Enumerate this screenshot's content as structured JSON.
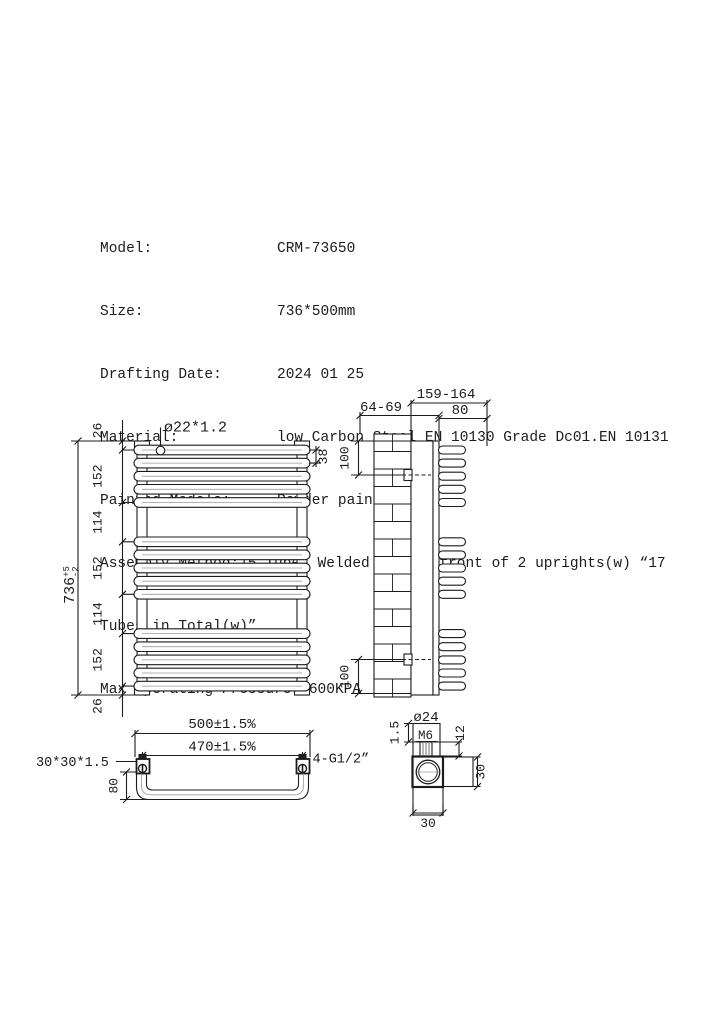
{
  "colors": {
    "line": "#1c1c1c",
    "background": "#ffffff",
    "inner_highlight": "#9a9a9a"
  },
  "specs": {
    "rows": [
      {
        "label": "Model:",
        "value": "CRM-73650"
      },
      {
        "label": "Size:",
        "value": "736*500mm"
      },
      {
        "label": "Drafting Date:",
        "value": "2024 01 25"
      },
      {
        "label": "Material:",
        "value": "low Carbon Steel EN 10130 Grade Dc01.EN 10131"
      },
      {
        "label": "Painted Models:",
        "value": "Powder painted"
      }
    ],
    "assembly_line1": "Assembly Method:15 Tubes Welded to the front of 2 uprights(w) “17",
    "assembly_line2": "Tubes in Total(w)”",
    "max_pressure": "Max Operating Pressure: 600KPA"
  },
  "front_view": {
    "tube_spec": "ø22*1.2",
    "tube_pitch": "38",
    "chain": [
      "26",
      "152",
      "114",
      "152",
      "114",
      "152",
      "26"
    ],
    "overall_height": "736",
    "tolerance_plus": "+5",
    "tolerance_minus": "-2"
  },
  "side_view": {
    "overall_depth": "159-164",
    "wall_distance": "64-69",
    "front_depth": "80",
    "bracket_offset_top": "100",
    "bracket_offset_bottom": "100"
  },
  "plan_view": {
    "overall_width": "500±1.5%",
    "upright_centers": "470±1.5%",
    "upright_spec": "30*30*1.5",
    "connections": "4-G1/2”",
    "bow_depth": "80"
  },
  "detail_view": {
    "plug_dia": "ø24",
    "thread": "M6",
    "wall_thickness": "1.5",
    "stem_height": "12",
    "section_height": "30",
    "section_width": "30"
  }
}
